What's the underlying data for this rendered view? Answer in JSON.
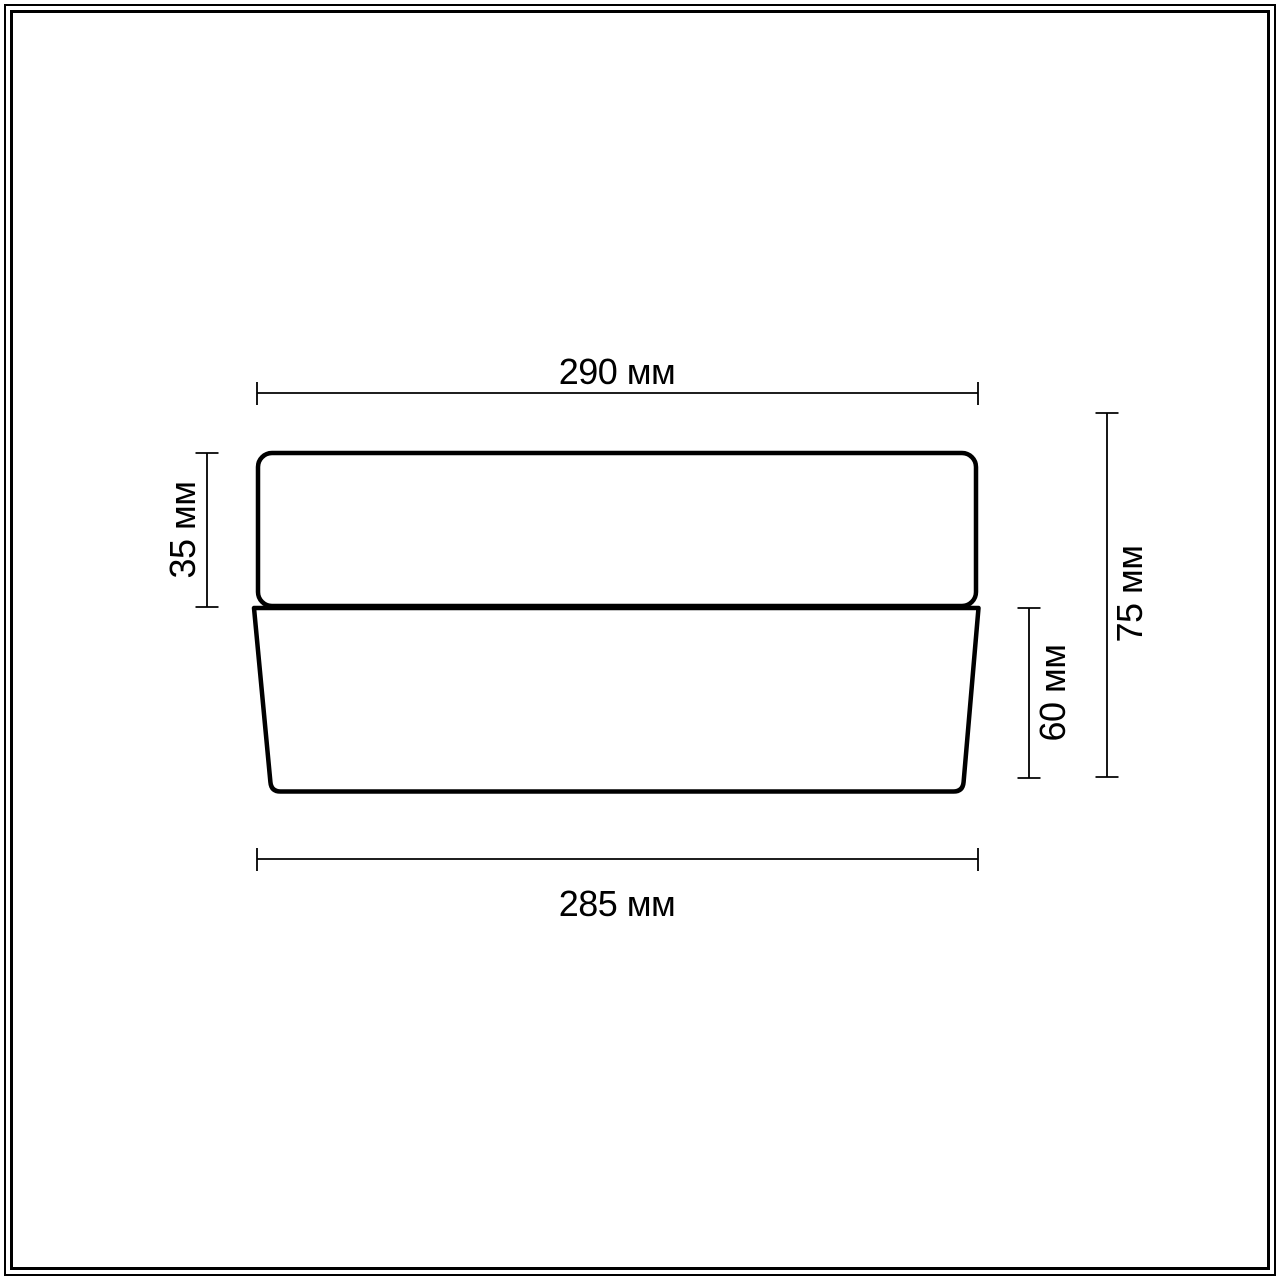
{
  "diagram": {
    "kind": "technical-dimension-drawing",
    "labels": {
      "top_width": "290 мм",
      "shade_height": "35 мм",
      "base_height": "60 мм",
      "total_height": "75 мм",
      "bottom_width": "285 мм"
    },
    "colors": {
      "line": "#000000",
      "background": "#ffffff"
    }
  }
}
